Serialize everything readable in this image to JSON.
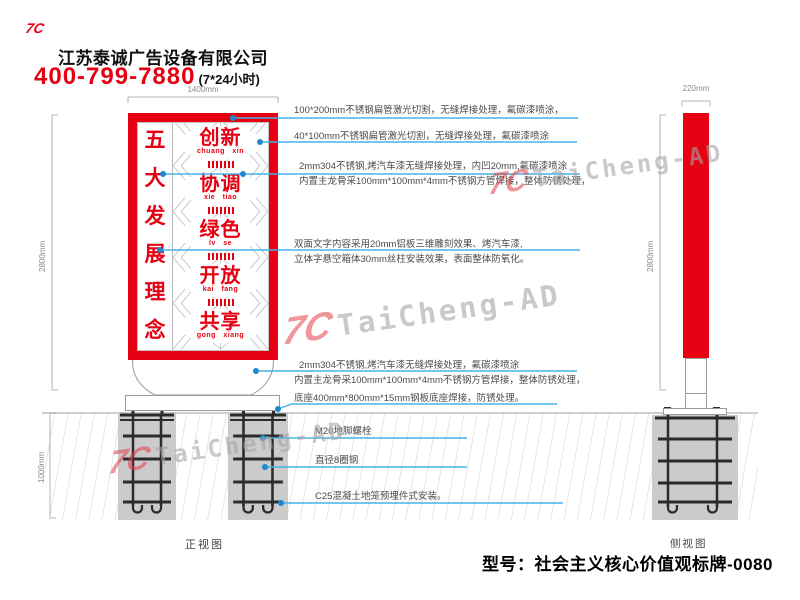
{
  "header": {
    "logo": "7C",
    "company": "江苏泰诚广告设备有限公司",
    "phone": "400-799-7880",
    "hotline": "(7*24小时)"
  },
  "front_view": {
    "label": "正视图",
    "dims": {
      "width": "1400mm",
      "height": "2800mm",
      "foundation_depth": "1000mm"
    },
    "sign": {
      "title_chars": [
        "五",
        "大",
        "发",
        "展",
        "理",
        "念"
      ],
      "words": [
        {
          "cn": "创新",
          "py": "chuang xin"
        },
        {
          "cn": "协调",
          "py": "xie tiao"
        },
        {
          "cn": "绿色",
          "py": "lv se"
        },
        {
          "cn": "开放",
          "py": "kai fang"
        },
        {
          "cn": "共享",
          "py": "gong xiang"
        }
      ]
    }
  },
  "side_view": {
    "label": "侧视图",
    "dims": {
      "depth": "220mm",
      "height": "2800mm"
    }
  },
  "annotations": [
    {
      "lines": [
        "100*200mm不锈钢扁管激光切割，无缝焊接处理，氟碳漆喷涂，"
      ]
    },
    {
      "lines": [
        "40*100mm不锈钢扁管激光切割，无缝焊接处理，氟碳漆喷涂"
      ]
    },
    {
      "lines": [
        "2mm304不锈钢,烤汽车漆无缝焊接处理，内凹20mm,氟碳漆喷涂",
        "内置主龙骨采100mm*100mm*4mm不锈钢方管焊接，整体防锈处理，"
      ]
    },
    {
      "lines": [
        "双面文字内容采用20mm铝板三维雕刻效果、烤汽车漆,",
        "立体字悬空箱体30mm丝柱安装效果，表面整体防氧化。"
      ]
    },
    {
      "lines": [
        "2mm304不锈钢,烤汽车漆无缝焊接处理，氟碳漆喷涂",
        "内置主龙骨采100mm*100mm*4mm不锈钢方管焊接，整体防锈处理，"
      ]
    },
    {
      "lines": [
        "底座400mm*800mm*15mm钢板底座焊接，防锈处理。"
      ]
    },
    {
      "lines": [
        "M20地脚螺栓"
      ]
    },
    {
      "lines": [
        "直径8圈钢"
      ]
    },
    {
      "lines": [
        "C25混凝土地笼预埋件式安装。"
      ]
    }
  ],
  "watermark": {
    "logo": "7C",
    "text": "TaiCheng-AD"
  },
  "footer": {
    "model": "型号：社会主义核心价值观标牌-0080"
  },
  "colors": {
    "brand_red": "#e60012",
    "leader_blue": "#45b3e8",
    "marker_blue": "#1e88cf",
    "foundation_gray": "#cbcbcb"
  }
}
